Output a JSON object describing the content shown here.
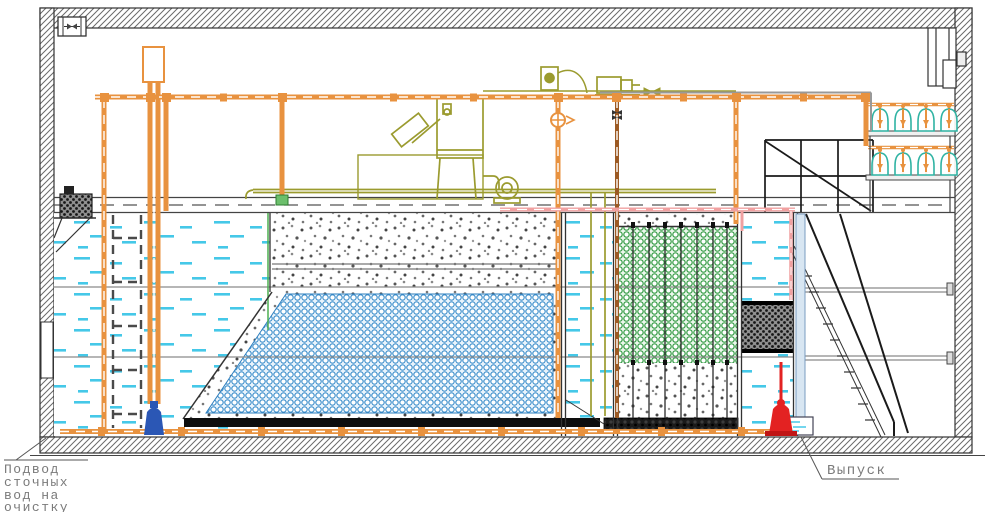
{
  "drawing": {
    "type": "engineering-section-drawing",
    "subject": "wastewater-treatment-unit-cross-section",
    "labels": {
      "inlet_lines": [
        "Подвод",
        "сточных",
        "вод на",
        "очистку"
      ],
      "outlet": "Выпуск"
    },
    "colors": {
      "air_pipe_orange": "#E8923F",
      "pipe_core_brown": "#9C5A24",
      "equipment_olive": "#9B9B2F",
      "water_dash_cyan": "#45C8E8",
      "media_blue": "#3E8FCB",
      "media_green": "#3A9E4A",
      "blower_teal": "#2FB3A3",
      "pipe_pink": "#F0A0A0",
      "outlet_pipe_lightblue": "#D8E6F2",
      "pump_red": "#E32222",
      "pump_blue": "#2B57B5",
      "wall_hatch_gray": "#666666",
      "label_gray": "#7a7a7a"
    },
    "components": [
      "ventilation-fan",
      "inlet-screen-basket",
      "expansion-tank",
      "screen-press-unit",
      "control-box",
      "blower-motor",
      "aeration-tank",
      "hidden-baffle",
      "gravel-bed",
      "blue-media-bed",
      "aeration-header",
      "transfer-channel",
      "green-biofilter-media",
      "fine-mesh-filter",
      "air-blower-rack-top",
      "air-blower-rack-bottom",
      "service-stairs",
      "platform-railing",
      "air-main-pipe",
      "pink-return-pipe",
      "outlet-pipe",
      "red-drain-pump",
      "blue-recycle-pump",
      "exhaust-duct",
      "wall-sluice"
    ]
  }
}
